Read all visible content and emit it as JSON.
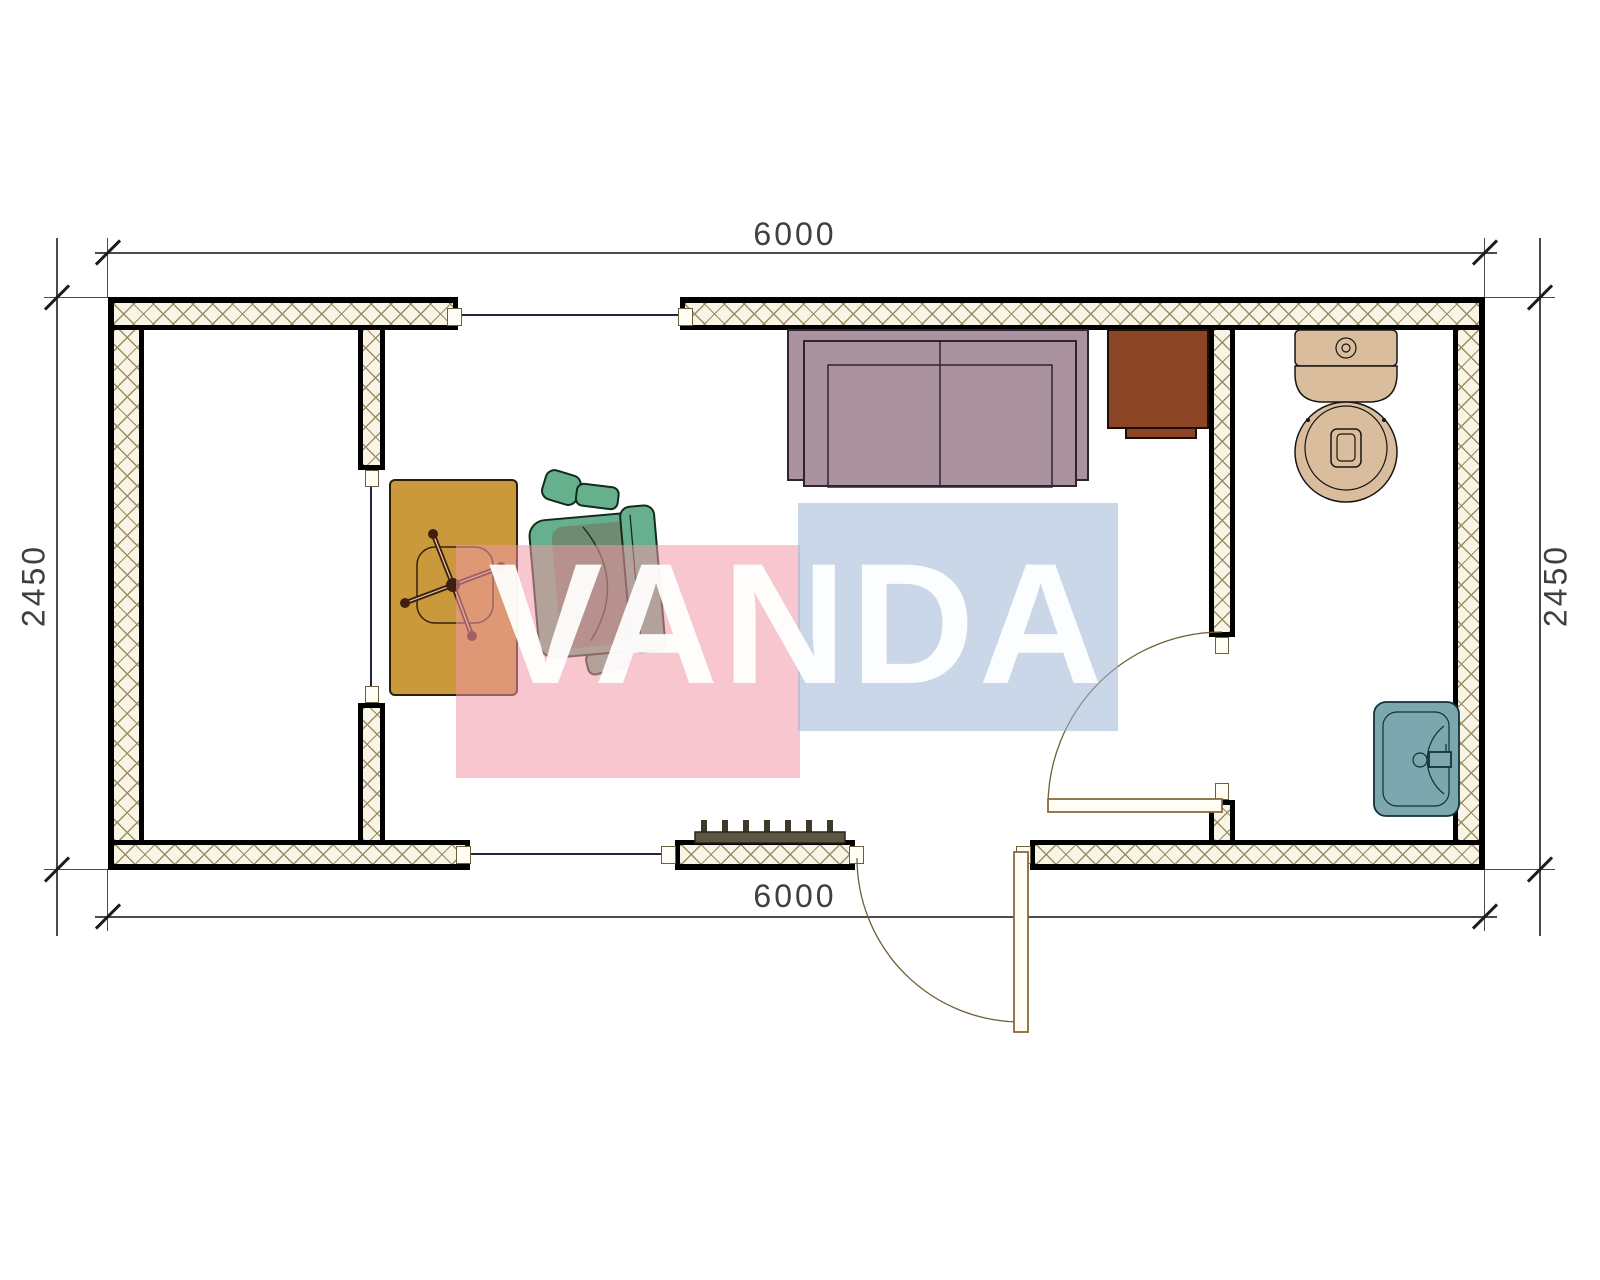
{
  "title": "container-office-floor-plan",
  "dimensions": {
    "top": "6000",
    "bottom": "6000",
    "left": "2450",
    "right": "2450"
  },
  "watermark": {
    "text": "VANDA"
  },
  "furniture": {
    "items": [
      "desk",
      "office-chair",
      "sofa",
      "cabinet",
      "toilet",
      "sink",
      "radiator",
      "entry-door",
      "bathroom-door"
    ]
  },
  "colors": {
    "hatch-bg": "#f8f4e6",
    "hatch-line": "#9b8c63",
    "window-line": "#23233f",
    "door-line": "#8a6a3c",
    "dim-line": "#4a4a4a",
    "dim-text": "#3f3f3f",
    "desk": "#c9993c",
    "chair-light": "#66b08d",
    "chair-dark": "#6f8b72",
    "sofa": "#ab929f",
    "cabinet": "#8c4524",
    "fixture": "#d9bd9c",
    "sink": "#7da7ae",
    "radiator": "#5d5540",
    "watermark-pink": "rgba(240,151,166,0.55)",
    "watermark-blue": "rgba(157,182,215,0.55)",
    "watermark-text": "rgba(255,255,255,0.94)"
  }
}
